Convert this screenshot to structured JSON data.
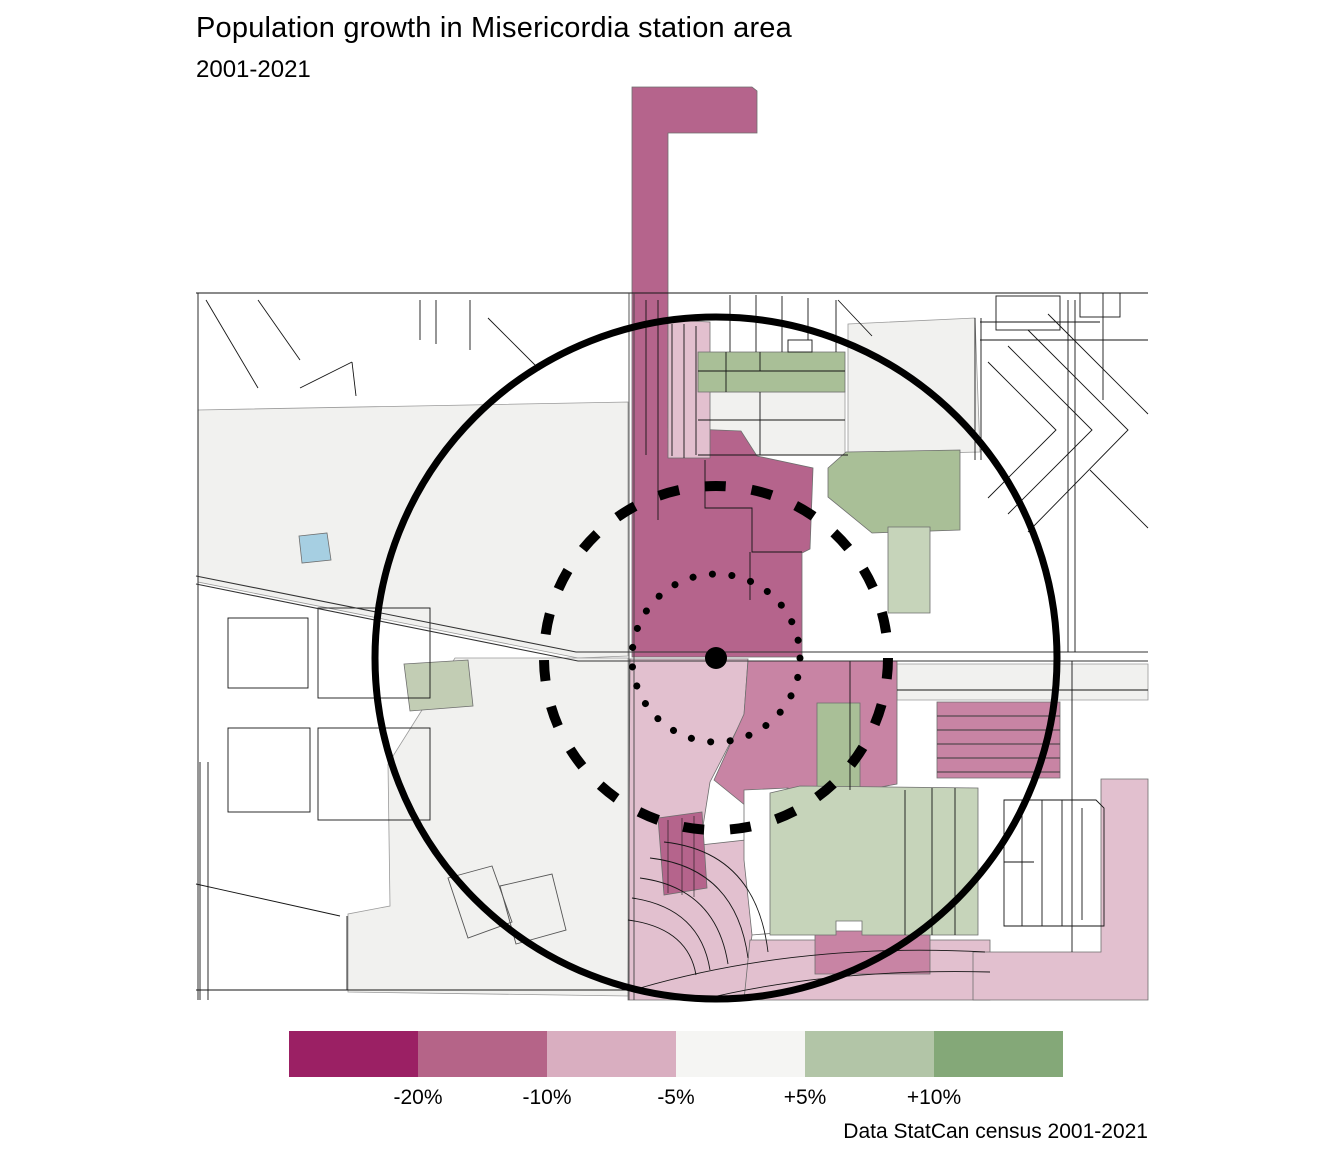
{
  "header": {
    "title": "Population growth in Misericordia station area",
    "subtitle": "2001-2021"
  },
  "source": {
    "text": "Data StatCan census 2001-2021"
  },
  "legend": {
    "swatches": [
      {
        "name": "decline-over-20pct",
        "color": "#9b2064"
      },
      {
        "name": "decline-10-20pct",
        "color": "#b56488"
      },
      {
        "name": "decline-5-10pct",
        "color": "#d9aec0"
      },
      {
        "name": "stable",
        "color": "#f5f5f3"
      },
      {
        "name": "growth-5-10pct",
        "color": "#b2c5a7"
      },
      {
        "name": "growth-over-10pct",
        "color": "#84a878"
      }
    ],
    "break_labels": [
      "-20%",
      "-10%",
      "-5%",
      "+5%",
      "+10%"
    ]
  },
  "map": {
    "palette": {
      "decline_strong": "#b5648c",
      "decline_mid": "#c884a4",
      "decline_light": "#e2c0cf",
      "stable_parcel": "#f1f1ef",
      "growth_mid": "#a9bf97",
      "growth_light": "#c6d4ba",
      "growth_pale": "#c2cdb4",
      "water": "#a6cfe2",
      "ring": "#000000"
    }
  }
}
